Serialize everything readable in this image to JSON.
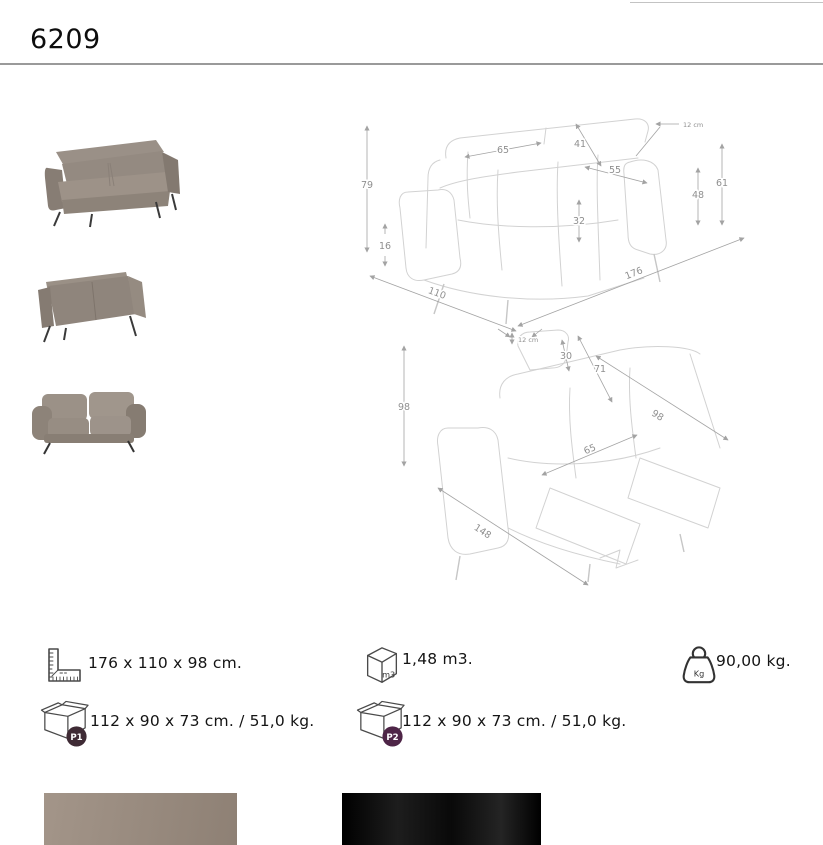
{
  "page": {
    "title": "6209"
  },
  "thumbnails": [
    {
      "name": "sofa-angled-view"
    },
    {
      "name": "sofa-rear-view"
    },
    {
      "name": "sofa-front-view"
    }
  ],
  "drawing_closed": {
    "dims": {
      "total_height": "79",
      "leg_height": "16",
      "headrest_width": "65",
      "backrest_length": "41",
      "seat_depth": "55",
      "seat_height": "32",
      "arm_height": "48",
      "back_height": "61",
      "headrest_extension": "12 cm",
      "total_width": "176",
      "total_depth": "110"
    }
  },
  "drawing_open": {
    "dims": {
      "total_height": "98",
      "headrest_extension": "12 cm",
      "headrest_height": "30",
      "backrest_length": "71",
      "recline_length": "98",
      "seat_width": "65",
      "open_depth": "148"
    }
  },
  "specs": {
    "overall_dimensions": {
      "icon": "ruler-icon",
      "text": "176 x 110 x 98 cm."
    },
    "volume": {
      "icon": "volume-cube-icon",
      "icon_label": "m3",
      "text": "1,48 m3."
    },
    "weight": {
      "icon": "weight-icon",
      "icon_label": "Kg",
      "text": "90,00 kg."
    },
    "packages": [
      {
        "icon": "package-box-icon",
        "badge": "P1",
        "badge_color": "#3f2b35",
        "text": "112 x 90 x 73 cm. / 51,0 kg."
      },
      {
        "icon": "package-box-icon",
        "badge": "P2",
        "badge_color": "#4e2547",
        "text": "112 x 90 x 73 cm. / 51,0 kg."
      }
    ]
  },
  "swatches": [
    {
      "name": "fabric-swatch-taupe",
      "color": "#9c8d80"
    },
    {
      "name": "fabric-swatch-black",
      "color": "#131313"
    }
  ]
}
